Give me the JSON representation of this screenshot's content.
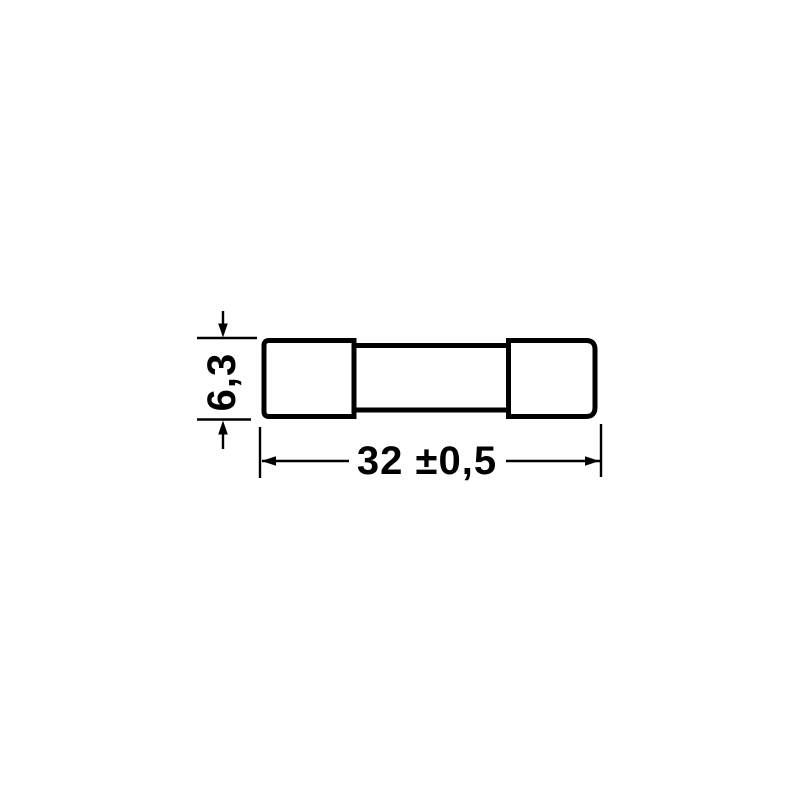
{
  "colors": {
    "line": "#000000",
    "background": "#ffffff"
  },
  "drawing": {
    "dimensions": {
      "height": {
        "label": "6,3",
        "value": 6.3,
        "unit": "mm"
      },
      "length": {
        "label": "32 ±0,5",
        "value": 32,
        "tolerance": 0.5,
        "unit": "mm"
      }
    }
  }
}
